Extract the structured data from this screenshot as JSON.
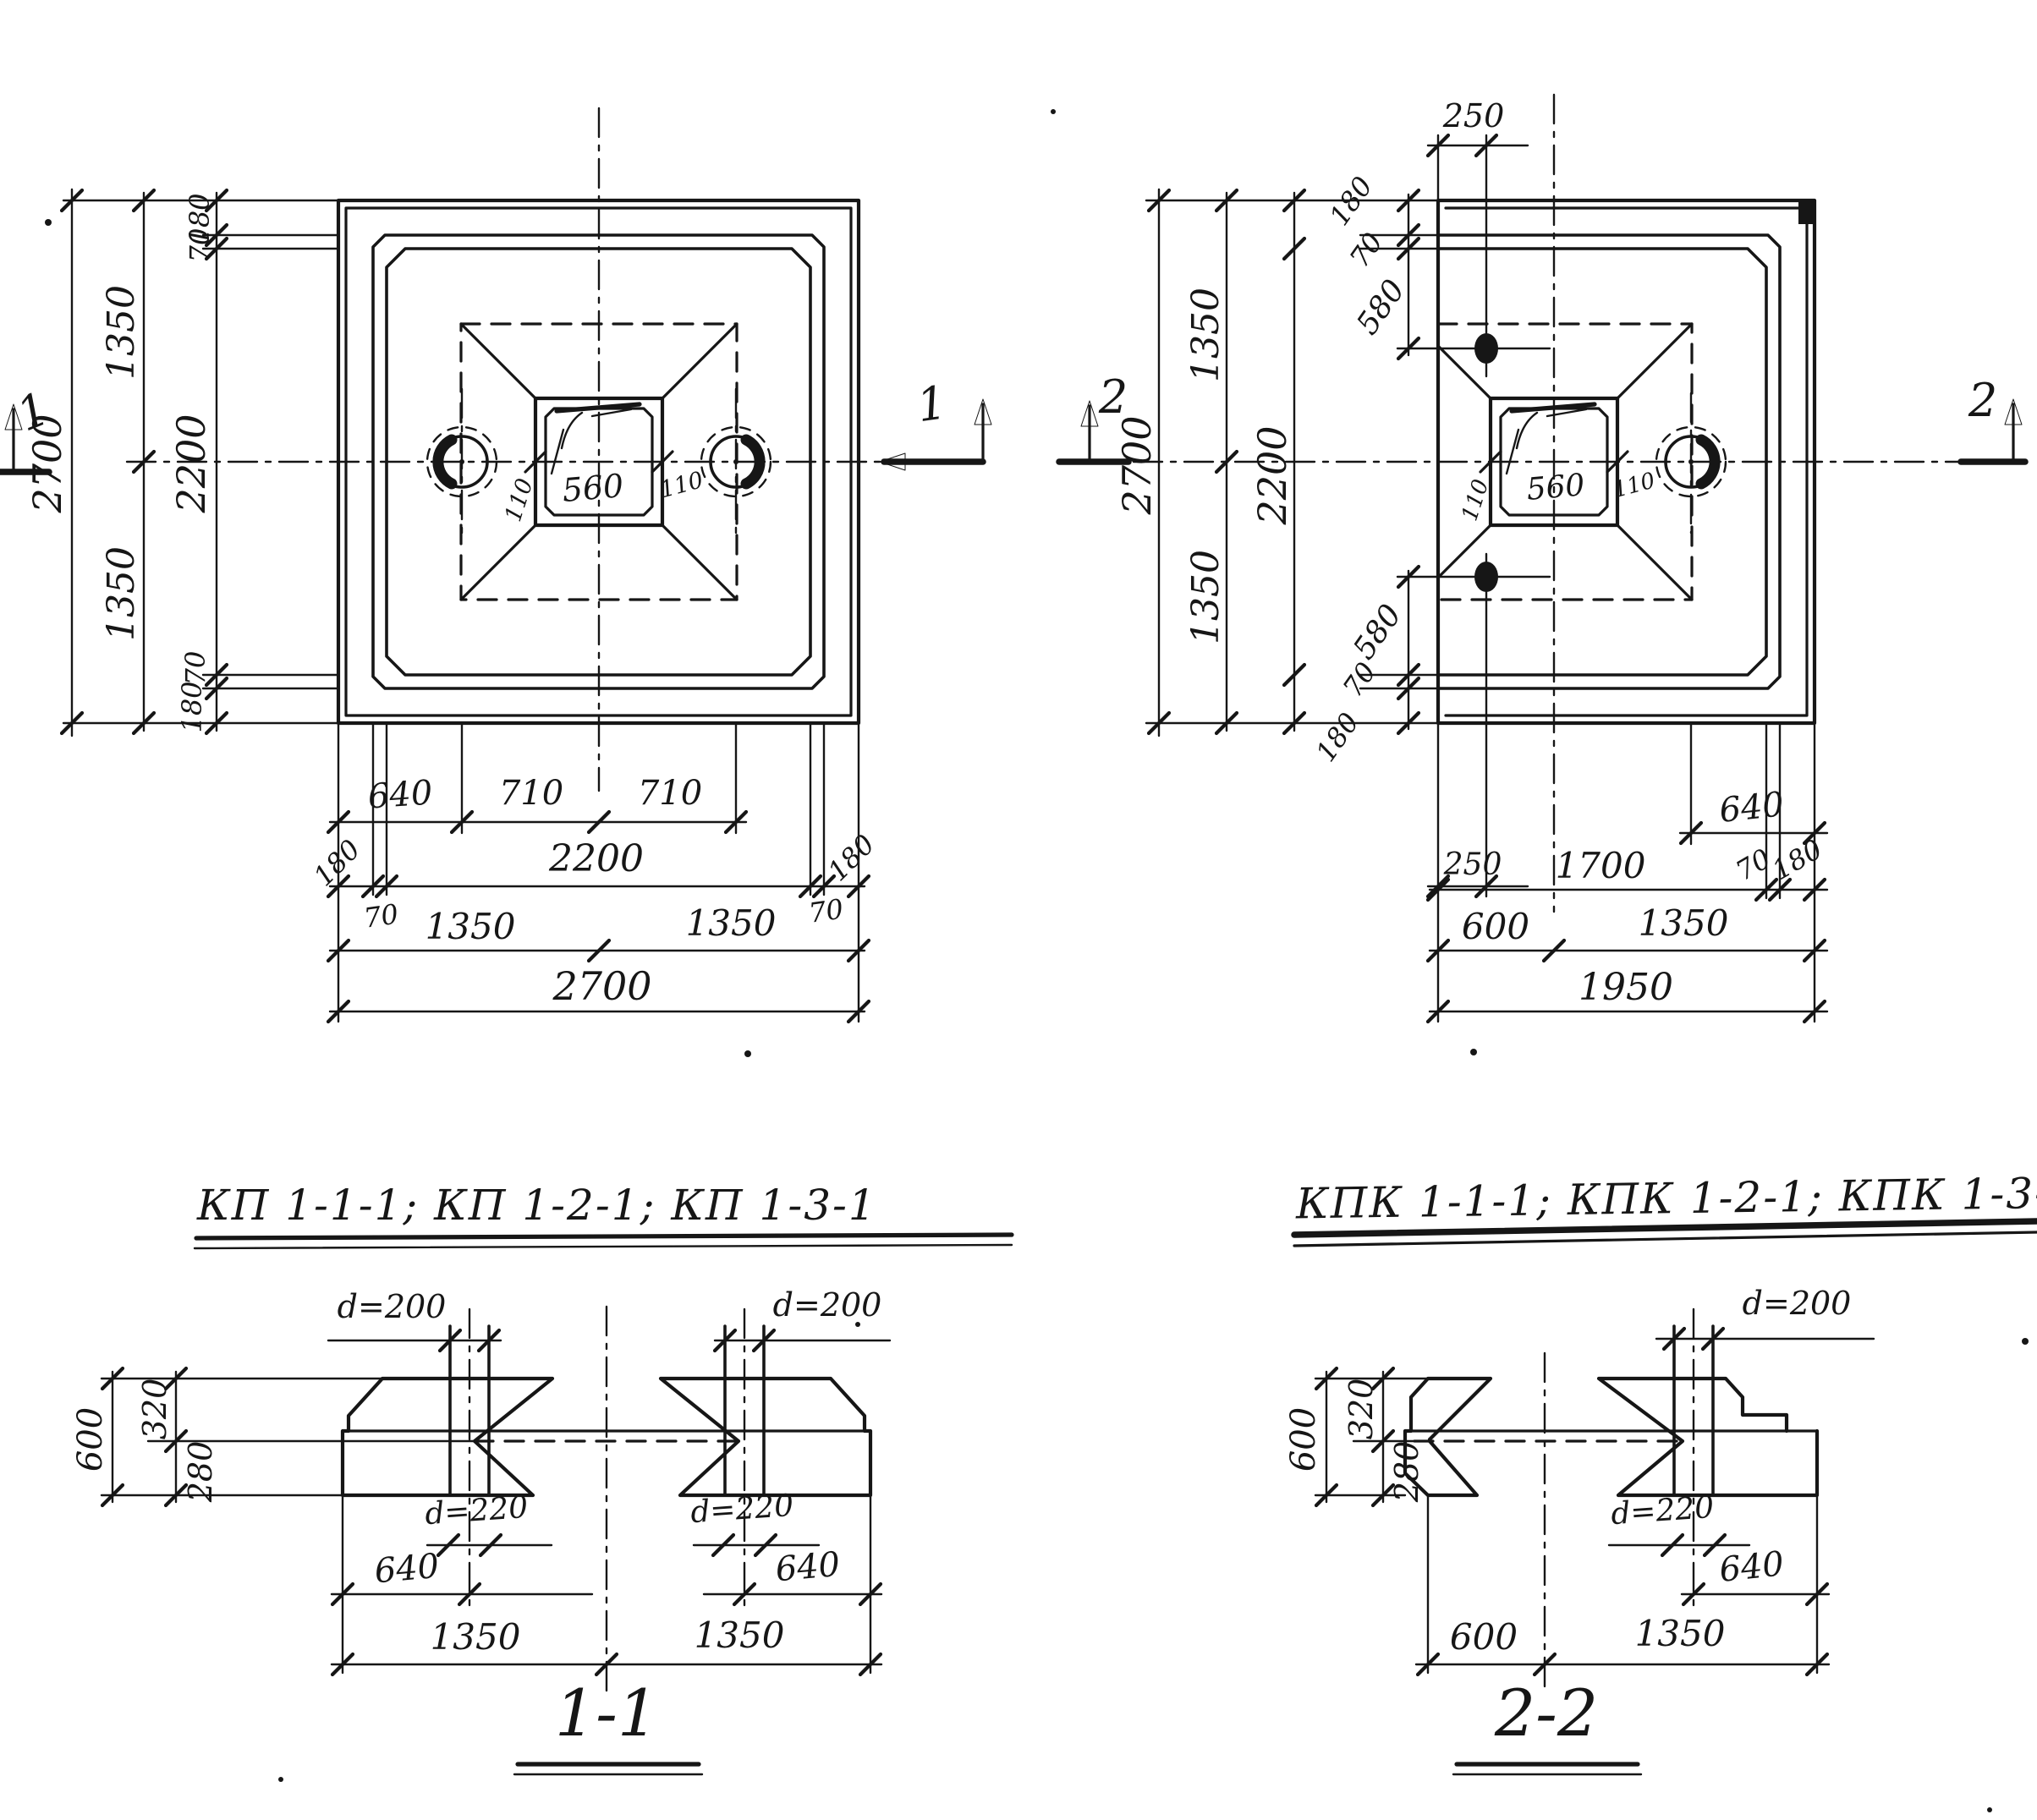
{
  "colors": {
    "ink": "#161616",
    "paper": "#ffffff"
  },
  "titles": {
    "plan_left": "КП 1-1-1; КП 1-2-1; КП 1-3-1",
    "plan_right": "КПК 1-1-1; КПК 1-2-1; КПК 1-3-1",
    "section_left": "1-1",
    "section_right": "2-2"
  },
  "labels": {
    "pl_chain_180_top": "180",
    "pl_chain_70_top": "70",
    "pl_chain_1350_u": "1350",
    "pl_chain_2700": "2700",
    "pl_chain_2200": "2200",
    "pl_chain_1350_l": "1350",
    "pl_chain_70_bot": "70",
    "pl_chain_180_bot": "180",
    "pl_row1_640": "640",
    "pl_row1_710a": "710",
    "pl_row1_710b": "710",
    "pl_row2_180l": "180",
    "pl_row2_2200": "2200",
    "pl_row2_180r": "180",
    "pl_row2_70l": "70",
    "pl_row2_70r": "70",
    "pl_row3_1350l": "1350",
    "pl_row3_1350r": "1350",
    "pl_row4_2700": "2700",
    "pl_socket_560": "560",
    "pl_socket_110l": "110",
    "pl_socket_110r": "110",
    "pl_marker_left": "1",
    "pl_marker_right": "1",
    "pr_top_250": "250",
    "pr_bot_250": "250",
    "pr_chain_2700": "2700",
    "pr_chain_1350_u": "1350",
    "pr_chain_1350_l": "1350",
    "pr_chain_2200": "2200",
    "pr_casc_top_180": "180",
    "pr_casc_top_70": "70",
    "pr_casc_top_580": "580",
    "pr_casc_bot_580": "580",
    "pr_casc_bot_70": "70",
    "pr_casc_bot_180": "180",
    "pr_rowA_640": "640",
    "pr_rowB_1700": "1700",
    "pr_rowB_70": "70",
    "pr_rowB_180": "180",
    "pr_rowC_600": "600",
    "pr_rowC_1350": "1350",
    "pr_rowD_1950": "1950",
    "pr_socket_560": "560",
    "pr_socket_110l": "110",
    "pr_socket_110r": "110",
    "pr_marker_left": "2",
    "pr_marker_right": "2",
    "s1_d200_l": "d=200",
    "s1_d200_r": "d=200",
    "s1_600": "600",
    "s1_320": "320",
    "s1_280": "280",
    "s1_d220_l": "d=220",
    "s1_d220_r": "d=220",
    "s1_640_l": "640",
    "s1_640_r": "640",
    "s1_1350_l": "1350",
    "s1_1350_r": "1350",
    "s2_d200": "d=200",
    "s2_600": "600",
    "s2_320": "320",
    "s2_280": "280",
    "s2_d220": "d=220",
    "s2_640": "640",
    "s2_600b": "600",
    "s2_1350": "1350"
  }
}
